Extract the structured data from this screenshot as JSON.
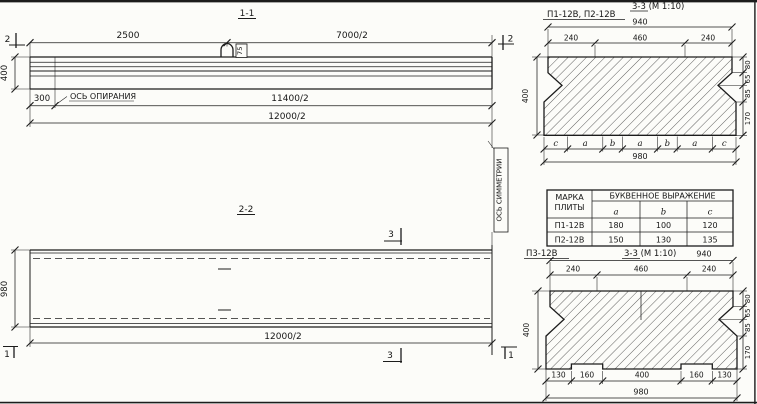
{
  "titles": {
    "s11": "1-1",
    "s22": "2-2",
    "s33_top": "3-3 (М 1:10)",
    "s33_bottom": "3-3 (М 1:10)",
    "plates_top": "П1-12В, П2-12В",
    "plate_bottom": "П3-12В"
  },
  "section11": {
    "dim_2500": "2500",
    "dim_7000_2": "7000/2",
    "dim_400": "400",
    "dim_300": "300",
    "dim_11400_2": "11400/2",
    "dim_12000_2": "12000/2",
    "support_axis": "ОСЬ ОПИРАНИЯ",
    "hook_label": "75",
    "marker_left": "2",
    "marker_right": "2"
  },
  "section22": {
    "dim_980": "980",
    "dim_12000_2": "12000/2",
    "marker_1_left": "1",
    "marker_1_right": "1",
    "marker_3_top": "3",
    "marker_3_bottom": "3",
    "symmetry_axis": "ОСЬ СИММЕТРИИ"
  },
  "section33top": {
    "dim_940": "940",
    "dim_240_left": "240",
    "dim_460": "460",
    "dim_240_right": "240",
    "dim_400": "400",
    "right_dims": [
      "80",
      "65",
      "85",
      "170"
    ],
    "letters": [
      "c",
      "a",
      "b",
      "a",
      "b",
      "a",
      "c"
    ],
    "dim_980": "980"
  },
  "table": {
    "col1_header_line1": "МАРКА",
    "col1_header_line2": "ПЛИТЫ",
    "col2_header": "БУКВЕННОЕ ВЫРАЖЕНИЕ",
    "sub_a": "a",
    "sub_b": "b",
    "sub_c": "c",
    "rows": [
      {
        "mark": "П1-12В",
        "a": "180",
        "b": "100",
        "c": "120"
      },
      {
        "mark": "П2-12В",
        "a": "150",
        "b": "130",
        "c": "135"
      }
    ]
  },
  "section33bottom": {
    "dim_940": "940",
    "dim_240_left": "240",
    "dim_460": "460",
    "dim_240_right": "240",
    "dim_400": "400",
    "right_dims": [
      "80",
      "65",
      "85",
      "170"
    ],
    "bottom_dims": [
      "130",
      "160",
      "400",
      "160",
      "130"
    ],
    "dim_980": "980"
  }
}
